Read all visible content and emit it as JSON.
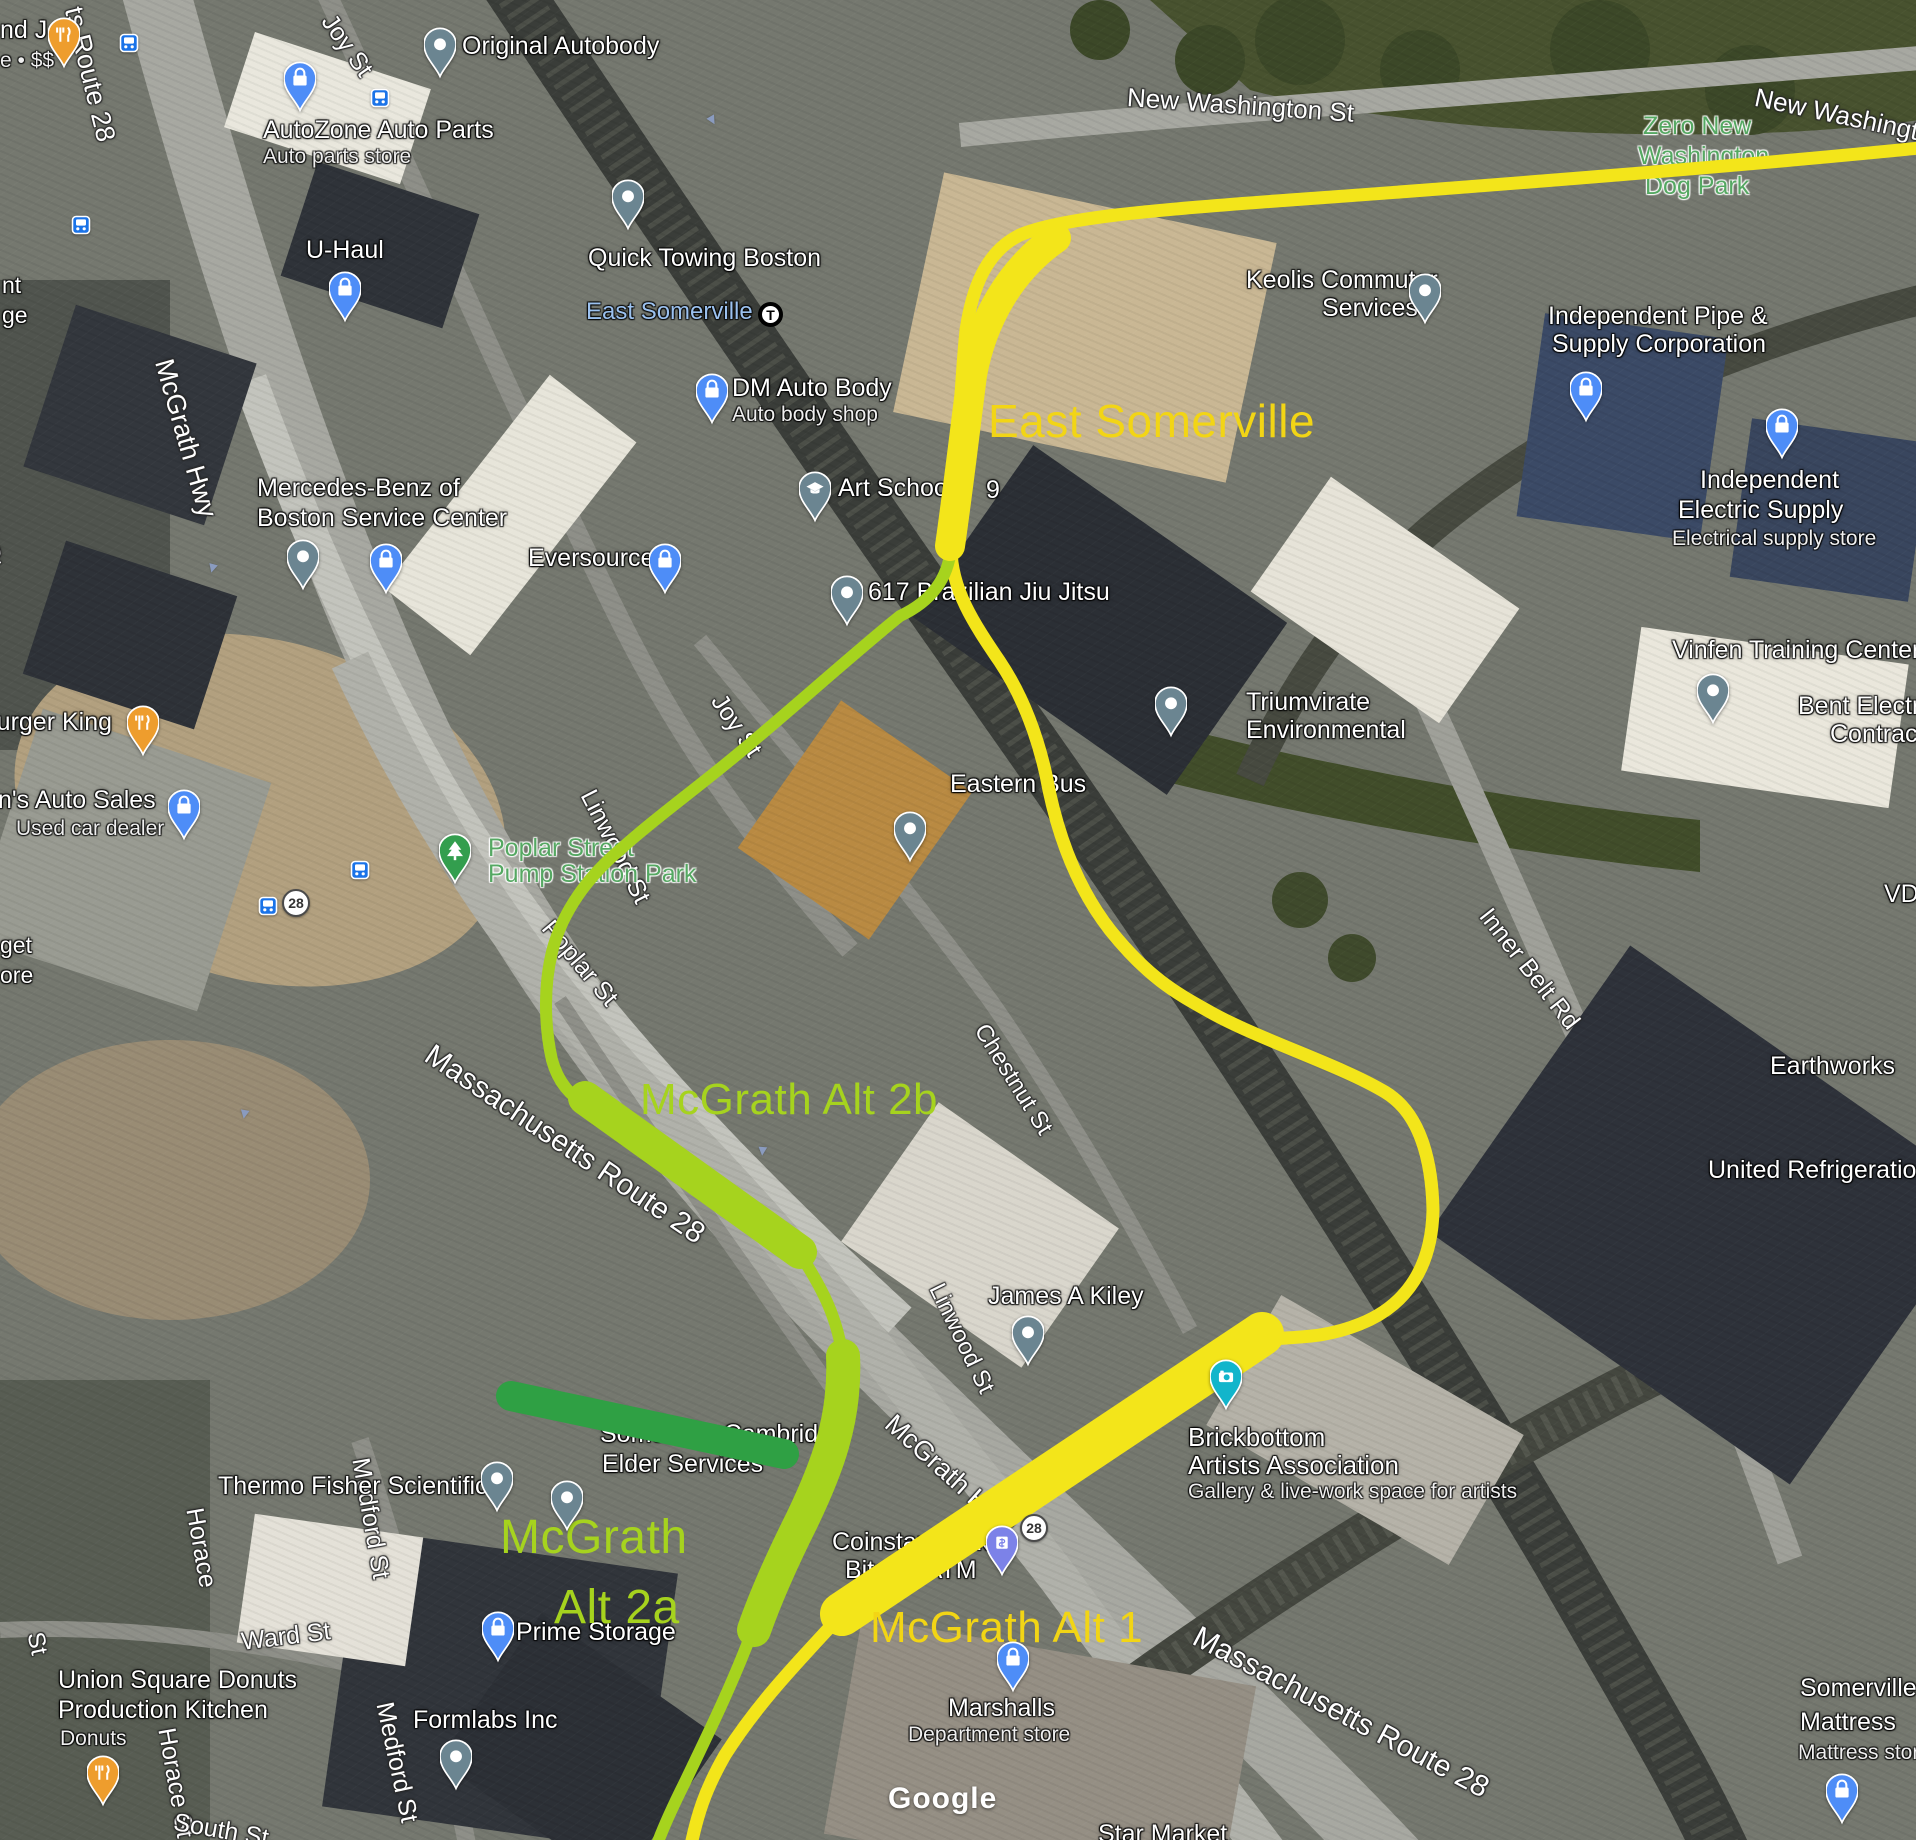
{
  "attribution": "Google",
  "routes": {
    "colors": {
      "Y": "#f3e51a",
      "G": "#a6d31e",
      "D": "#2fa044"
    },
    "lines": [
      {
        "name": "mcgrath-alt-1-yellow-route-line",
        "color": "Y",
        "w": 13,
        "d": "M1920,148 C1750,165 1500,185 1290,200 C1150,210 1060,218 1020,235 C985,252 972,290 966,330 C960,390 958,460 951,548 C951,590 975,625 1000,662 C1020,692 1036,730 1046,775 C1056,830 1075,885 1110,930 C1150,980 1180,995 1210,1012 C1260,1040 1340,1065 1385,1092 C1420,1113 1432,1160 1433,1210 C1432,1265 1408,1305 1360,1324 C1320,1340 1292,1336 1262,1340 L842,1614 C800,1660 760,1700 725,1755 C705,1790 697,1815 690,1850"
      },
      {
        "name": "mcgrath-alt-2-green-route-line",
        "color": "G",
        "w": 12,
        "d": "M951,548 C948,580 930,602 900,616 C860,648 800,702 745,748 C700,786 650,822 622,848 C588,876 562,912 552,952 C544,985 544,1025 552,1060 C558,1082 570,1096 588,1106 L800,1254 C822,1288 838,1318 843,1360 C846,1420 826,1470 802,1520 C786,1552 768,1592 752,1632 C730,1690 705,1740 685,1782 C672,1808 662,1830 655,1850"
      }
    ],
    "bands": [
      {
        "name": "east-somerville-station-band",
        "color": "Y",
        "w": 30,
        "d": "M1056,238 C1010,270 982,320 972,375 C965,430 958,490 950,546"
      },
      {
        "name": "mcgrath-alt-1-band",
        "color": "Y",
        "w": 44,
        "d": "M1262,1334 L842,1614"
      },
      {
        "name": "mcgrath-alt-2b-band",
        "color": "G",
        "w": 34,
        "d": "M585,1098 L800,1252"
      },
      {
        "name": "mcgrath-alt-2a-band",
        "color": "G",
        "w": 34,
        "d": "M843,1356 C846,1420 826,1470 802,1520 C786,1552 768,1590 754,1630"
      },
      {
        "name": "elevated-mcgrath-band",
        "color": "D",
        "w": 30,
        "d": "M511,1396 L784,1454"
      }
    ]
  },
  "route_labels": [
    {
      "t": "East Somerville",
      "x": 988,
      "y": 398,
      "s": 46,
      "c": "ov-y"
    },
    {
      "t": "McGrath Alt 2b",
      "x": 640,
      "y": 1078,
      "s": 44,
      "c": "ov-g"
    },
    {
      "t": "McGrath",
      "x": 500,
      "y": 1514,
      "s": 48,
      "c": "ov-g"
    },
    {
      "t": "Alt 2a",
      "x": 554,
      "y": 1584,
      "s": 48,
      "c": "ov-g"
    },
    {
      "t": "McGrath Alt 1",
      "x": 870,
      "y": 1606,
      "s": 44,
      "c": "ov-y"
    }
  ],
  "map_labels": [
    {
      "t": "ts Route 28",
      "x": 86,
      "y": 4,
      "s": 27,
      "c": "st",
      "r": 76
    },
    {
      "t": "Joy St",
      "x": 337,
      "y": 10,
      "s": 25,
      "c": "st",
      "r": 55
    },
    {
      "t": "New Washington St",
      "x": 1128,
      "y": 84,
      "s": 26,
      "c": "st",
      "r": 4
    },
    {
      "t": "New Washington St",
      "x": 1758,
      "y": 84,
      "s": 26,
      "c": "st",
      "r": 12
    },
    {
      "t": "McGrath Hwy",
      "x": 176,
      "y": 356,
      "s": 27,
      "c": "st",
      "r": 74
    },
    {
      "t": "field St",
      "x": -8,
      "y": 490,
      "s": 25,
      "c": "st",
      "r": 80
    },
    {
      "t": "St",
      "x": -4,
      "y": 556,
      "s": 24,
      "c": "st",
      "r": 80
    },
    {
      "t": "Joy St",
      "x": 727,
      "y": 690,
      "s": 25,
      "c": "st",
      "r": 56
    },
    {
      "t": "Linwood St",
      "x": 598,
      "y": 786,
      "s": 25,
      "c": "st",
      "r": 63
    },
    {
      "t": "Poplar St",
      "x": 556,
      "y": 916,
      "s": 25,
      "c": "st",
      "r": 50
    },
    {
      "t": "Massachusetts Route 28",
      "x": 436,
      "y": 1040,
      "s": 30,
      "c": "st",
      "r": 34
    },
    {
      "t": "Chestnut St",
      "x": 990,
      "y": 1020,
      "s": 24,
      "c": "st",
      "r": 58
    },
    {
      "t": "Inner Belt Rd",
      "x": 1494,
      "y": 904,
      "s": 25,
      "c": "st",
      "r": 52
    },
    {
      "t": "Linwood St",
      "x": 946,
      "y": 1280,
      "s": 24,
      "c": "st",
      "r": 64
    },
    {
      "t": "Fitchburg St",
      "x": 1080,
      "y": 1454,
      "s": 23,
      "c": "st",
      "r": -38
    },
    {
      "t": "McGrath Hwy",
      "x": 898,
      "y": 1410,
      "s": 27,
      "c": "st",
      "r": 42
    },
    {
      "t": "Massachusetts Route 28",
      "x": 1202,
      "y": 1622,
      "s": 30,
      "c": "st",
      "r": 28
    },
    {
      "t": "Ward St",
      "x": 240,
      "y": 1630,
      "s": 25,
      "c": "st",
      "r": -7
    },
    {
      "t": "Horace",
      "x": 206,
      "y": 1506,
      "s": 25,
      "c": "st",
      "r": 80
    },
    {
      "t": "Horace St",
      "x": 178,
      "y": 1726,
      "s": 25,
      "c": "st",
      "r": 80
    },
    {
      "t": "Medford St",
      "x": 372,
      "y": 1456,
      "s": 25,
      "c": "st",
      "r": 80
    },
    {
      "t": "Medford St",
      "x": 396,
      "y": 1700,
      "s": 25,
      "c": "st",
      "r": 78
    },
    {
      "t": "South St",
      "x": 176,
      "y": 1810,
      "s": 25,
      "c": "st",
      "r": 10
    },
    {
      "t": "St",
      "x": 46,
      "y": 1630,
      "s": 24,
      "c": "st",
      "r": 78
    },
    {
      "t": "nd J",
      "x": 0,
      "y": 18,
      "s": 25,
      "c": "pl"
    },
    {
      "t": "e • $$",
      "x": 0,
      "y": 50,
      "s": 21,
      "c": "sub"
    },
    {
      "t": "AutoZone Auto Parts",
      "x": 263,
      "y": 118,
      "s": 25,
      "c": "pl"
    },
    {
      "t": "Auto parts store",
      "x": 263,
      "y": 146,
      "s": 21,
      "c": "sub"
    },
    {
      "t": "Original Autobody",
      "x": 462,
      "y": 34,
      "s": 25,
      "c": "pl"
    },
    {
      "t": "U-Haul",
      "x": 306,
      "y": 238,
      "s": 25,
      "c": "pl"
    },
    {
      "t": "Quick Towing Boston",
      "x": 588,
      "y": 246,
      "s": 25,
      "c": "pl"
    },
    {
      "t": "East Somerville",
      "x": 586,
      "y": 300,
      "s": 24,
      "c": "tr"
    },
    {
      "t": "DM Auto Body",
      "x": 732,
      "y": 376,
      "s": 25,
      "c": "pl"
    },
    {
      "t": "Auto body shop",
      "x": 732,
      "y": 404,
      "s": 21,
      "c": "sub"
    },
    {
      "t": "Mercedes-Benz of",
      "x": 257,
      "y": 476,
      "s": 25,
      "c": "pl"
    },
    {
      "t": "Boston Service Center",
      "x": 257,
      "y": 506,
      "s": 25,
      "c": "pl"
    },
    {
      "t": "Eversource",
      "x": 528,
      "y": 546,
      "s": 25,
      "c": "pl"
    },
    {
      "t": "Art School",
      "x": 838,
      "y": 476,
      "s": 25,
      "c": "pl"
    },
    {
      "t": "9",
      "x": 986,
      "y": 478,
      "s": 25,
      "c": "pl"
    },
    {
      "t": "617 Brazilian Jiu Jitsu",
      "x": 868,
      "y": 580,
      "s": 25,
      "c": "pl"
    },
    {
      "t": "Keolis Commuter",
      "x": 1246,
      "y": 268,
      "s": 25,
      "c": "pl"
    },
    {
      "t": "Services",
      "x": 1322,
      "y": 296,
      "s": 25,
      "c": "pl"
    },
    {
      "t": "Independent Pipe &",
      "x": 1548,
      "y": 304,
      "s": 25,
      "c": "pl"
    },
    {
      "t": "Supply Corporation",
      "x": 1552,
      "y": 332,
      "s": 25,
      "c": "pl"
    },
    {
      "t": "Independent",
      "x": 1700,
      "y": 468,
      "s": 25,
      "c": "pl"
    },
    {
      "t": "Electric Supply",
      "x": 1678,
      "y": 498,
      "s": 25,
      "c": "pl"
    },
    {
      "t": "Electrical supply store",
      "x": 1672,
      "y": 528,
      "s": 21,
      "c": "sub"
    },
    {
      "t": "Zero New",
      "x": 1643,
      "y": 114,
      "s": 25,
      "c": "park"
    },
    {
      "t": "Washington",
      "x": 1638,
      "y": 144,
      "s": 25,
      "c": "park"
    },
    {
      "t": "Dog Park",
      "x": 1645,
      "y": 174,
      "s": 25,
      "c": "park"
    },
    {
      "t": "Burger King",
      "x": -20,
      "y": 710,
      "s": 25,
      "c": "pl"
    },
    {
      "t": "n's Auto Sales",
      "x": -2,
      "y": 788,
      "s": 25,
      "c": "pl"
    },
    {
      "t": "Used car dealer",
      "x": 16,
      "y": 818,
      "s": 21,
      "c": "sub"
    },
    {
      "t": "Triumvirate",
      "x": 1246,
      "y": 690,
      "s": 25,
      "c": "pl"
    },
    {
      "t": "Environmental",
      "x": 1246,
      "y": 718,
      "s": 25,
      "c": "pl"
    },
    {
      "t": "Eastern Bus",
      "x": 950,
      "y": 772,
      "s": 25,
      "c": "pl"
    },
    {
      "t": "Vinfen Training Center",
      "x": 1672,
      "y": 638,
      "s": 25,
      "c": "pl"
    },
    {
      "t": "Bent Electric",
      "x": 1798,
      "y": 694,
      "s": 25,
      "c": "pl"
    },
    {
      "t": "Contractors",
      "x": 1830,
      "y": 722,
      "s": 25,
      "c": "pl"
    },
    {
      "t": "VDC",
      "x": 1884,
      "y": 882,
      "s": 25,
      "c": "pl"
    },
    {
      "t": "Earthworks",
      "x": 1770,
      "y": 1054,
      "s": 25,
      "c": "pl"
    },
    {
      "t": "United Refrigeration",
      "x": 1708,
      "y": 1158,
      "s": 25,
      "c": "pl"
    },
    {
      "t": "Poplar Street",
      "x": 488,
      "y": 836,
      "s": 25,
      "c": "park"
    },
    {
      "t": "Pump Station Park",
      "x": 488,
      "y": 862,
      "s": 25,
      "c": "park"
    },
    {
      "t": "James A Kiley",
      "x": 988,
      "y": 1284,
      "s": 25,
      "c": "pl"
    },
    {
      "t": "Brickbottom",
      "x": 1188,
      "y": 1424,
      "s": 26,
      "c": "pl"
    },
    {
      "t": "Artists Association",
      "x": 1188,
      "y": 1452,
      "s": 26,
      "c": "pl"
    },
    {
      "t": "Gallery & live-work space for artists",
      "x": 1188,
      "y": 1481,
      "s": 21,
      "c": "sub"
    },
    {
      "t": "Coinstar kiosk",
      "x": 832,
      "y": 1530,
      "s": 25,
      "c": "pl"
    },
    {
      "t": "Bitcoin ATM",
      "x": 845,
      "y": 1558,
      "s": 25,
      "c": "pl"
    },
    {
      "t": "Somerville Cambridge",
      "x": 600,
      "y": 1422,
      "s": 25,
      "c": "pl"
    },
    {
      "t": "Elder Services",
      "x": 602,
      "y": 1452,
      "s": 25,
      "c": "pl"
    },
    {
      "t": "Thermo Fisher Scientific",
      "x": 218,
      "y": 1474,
      "s": 25,
      "c": "pl"
    },
    {
      "t": "Prime Storage",
      "x": 516,
      "y": 1620,
      "s": 25,
      "c": "pl"
    },
    {
      "t": "Formlabs Inc",
      "x": 413,
      "y": 1708,
      "s": 25,
      "c": "pl"
    },
    {
      "t": "Marshalls",
      "x": 948,
      "y": 1696,
      "s": 25,
      "c": "pl"
    },
    {
      "t": "Department store",
      "x": 908,
      "y": 1724,
      "s": 21,
      "c": "sub"
    },
    {
      "t": "Union Square Donuts",
      "x": 58,
      "y": 1668,
      "s": 25,
      "c": "pl"
    },
    {
      "t": "Production Kitchen",
      "x": 58,
      "y": 1698,
      "s": 25,
      "c": "pl"
    },
    {
      "t": "Donuts",
      "x": 60,
      "y": 1728,
      "s": 21,
      "c": "sub"
    },
    {
      "t": "Somerville",
      "x": 1800,
      "y": 1676,
      "s": 25,
      "c": "pl"
    },
    {
      "t": "Mattress",
      "x": 1800,
      "y": 1710,
      "s": 25,
      "c": "pl"
    },
    {
      "t": "Mattress store",
      "x": 1798,
      "y": 1742,
      "s": 21,
      "c": "sub"
    },
    {
      "t": "Star Market",
      "x": 1098,
      "y": 1822,
      "s": 25,
      "c": "pl"
    },
    {
      "t": "nt",
      "x": 2,
      "y": 274,
      "s": 23,
      "c": "pl"
    },
    {
      "t": "ge",
      "x": 2,
      "y": 304,
      "s": 23,
      "c": "pl"
    },
    {
      "t": "get",
      "x": 0,
      "y": 934,
      "s": 23,
      "c": "pl"
    },
    {
      "t": "ore",
      "x": 0,
      "y": 964,
      "s": 23,
      "c": "pl"
    }
  ],
  "pins": [
    {
      "type": "restaurant",
      "x": 64,
      "y": 34,
      "n": "restaurant-pin-top-left"
    },
    {
      "type": "restaurant",
      "x": 143,
      "y": 722,
      "n": "restaurant-pin-burger-king"
    },
    {
      "type": "restaurant",
      "x": 103,
      "y": 1772,
      "n": "restaurant-pin-union-square-donuts"
    },
    {
      "type": "bag",
      "x": 300,
      "y": 78,
      "n": "store-pin-autozone"
    },
    {
      "type": "bag",
      "x": 345,
      "y": 288,
      "n": "store-pin-u-haul"
    },
    {
      "type": "bag",
      "x": 712,
      "y": 390,
      "n": "store-pin-dm-auto-body"
    },
    {
      "type": "bag",
      "x": 386,
      "y": 560,
      "n": "store-pin-mercedes-benz"
    },
    {
      "type": "bag",
      "x": 665,
      "y": 560,
      "n": "store-pin-eversource"
    },
    {
      "type": "bag",
      "x": 184,
      "y": 806,
      "n": "store-pin-auto-sales"
    },
    {
      "type": "bag",
      "x": 1586,
      "y": 388,
      "n": "store-pin-independent-pipe"
    },
    {
      "type": "bag",
      "x": 1782,
      "y": 425,
      "n": "store-pin-independent-electric"
    },
    {
      "type": "bag",
      "x": 498,
      "y": 1628,
      "n": "store-pin-prime-storage"
    },
    {
      "type": "bag",
      "x": 1013,
      "y": 1658,
      "n": "store-pin-marshalls"
    },
    {
      "type": "bag",
      "x": 1842,
      "y": 1790,
      "n": "store-pin-somerville-mattress"
    },
    {
      "type": "dot",
      "x": 440,
      "y": 44,
      "n": "place-pin-original-autobody"
    },
    {
      "type": "dot",
      "x": 628,
      "y": 196,
      "n": "place-pin-quick-towing"
    },
    {
      "type": "dot",
      "x": 303,
      "y": 556,
      "n": "place-pin-mercedes-service"
    },
    {
      "type": "dot",
      "x": 847,
      "y": 592,
      "n": "place-pin-617-brazilian-jiu-jitsu"
    },
    {
      "type": "dot",
      "x": 1425,
      "y": 290,
      "n": "place-pin-keolis"
    },
    {
      "type": "dot",
      "x": 1171,
      "y": 703,
      "n": "place-pin-triumvirate"
    },
    {
      "type": "dot",
      "x": 1713,
      "y": 690,
      "n": "place-pin-vinfen"
    },
    {
      "type": "dot",
      "x": 910,
      "y": 828,
      "n": "place-pin-eastern-bus"
    },
    {
      "type": "dot",
      "x": 1028,
      "y": 1332,
      "n": "place-pin-james-a-kiley"
    },
    {
      "type": "dot",
      "x": 497,
      "y": 1478,
      "n": "place-pin-thermo-fisher"
    },
    {
      "type": "dot",
      "x": 567,
      "y": 1497,
      "n": "place-pin-elder-services"
    },
    {
      "type": "dot",
      "x": 456,
      "y": 1756,
      "n": "place-pin-formlabs"
    },
    {
      "type": "school",
      "x": 815,
      "y": 488,
      "n": "school-pin-art-school"
    },
    {
      "type": "tree",
      "x": 455,
      "y": 850,
      "n": "park-pin-poplar-street-pump-station"
    },
    {
      "type": "camera",
      "x": 1226,
      "y": 1376,
      "n": "photo-pin-brickbottom"
    },
    {
      "type": "atm",
      "x": 1002,
      "y": 1542,
      "n": "atm-pin-coinstar"
    }
  ],
  "bus_stops": [
    {
      "x": 129,
      "y": 43
    },
    {
      "x": 81,
      "y": 225
    },
    {
      "x": 380,
      "y": 98
    },
    {
      "x": 360,
      "y": 870
    },
    {
      "x": 268,
      "y": 906
    }
  ],
  "shields": [
    {
      "t": "28",
      "x": 296,
      "y": 903
    },
    {
      "t": "28",
      "x": 1034,
      "y": 1528
    }
  ],
  "transit_stations": [
    {
      "t": "T",
      "x": 770,
      "y": 314
    }
  ],
  "traffic_arrows": [
    {
      "x": 205,
      "y": 560,
      "r": 195
    },
    {
      "x": 237,
      "y": 1106,
      "r": 190
    },
    {
      "x": 705,
      "y": 112,
      "r": 150
    },
    {
      "x": 755,
      "y": 1143,
      "r": 185
    }
  ]
}
